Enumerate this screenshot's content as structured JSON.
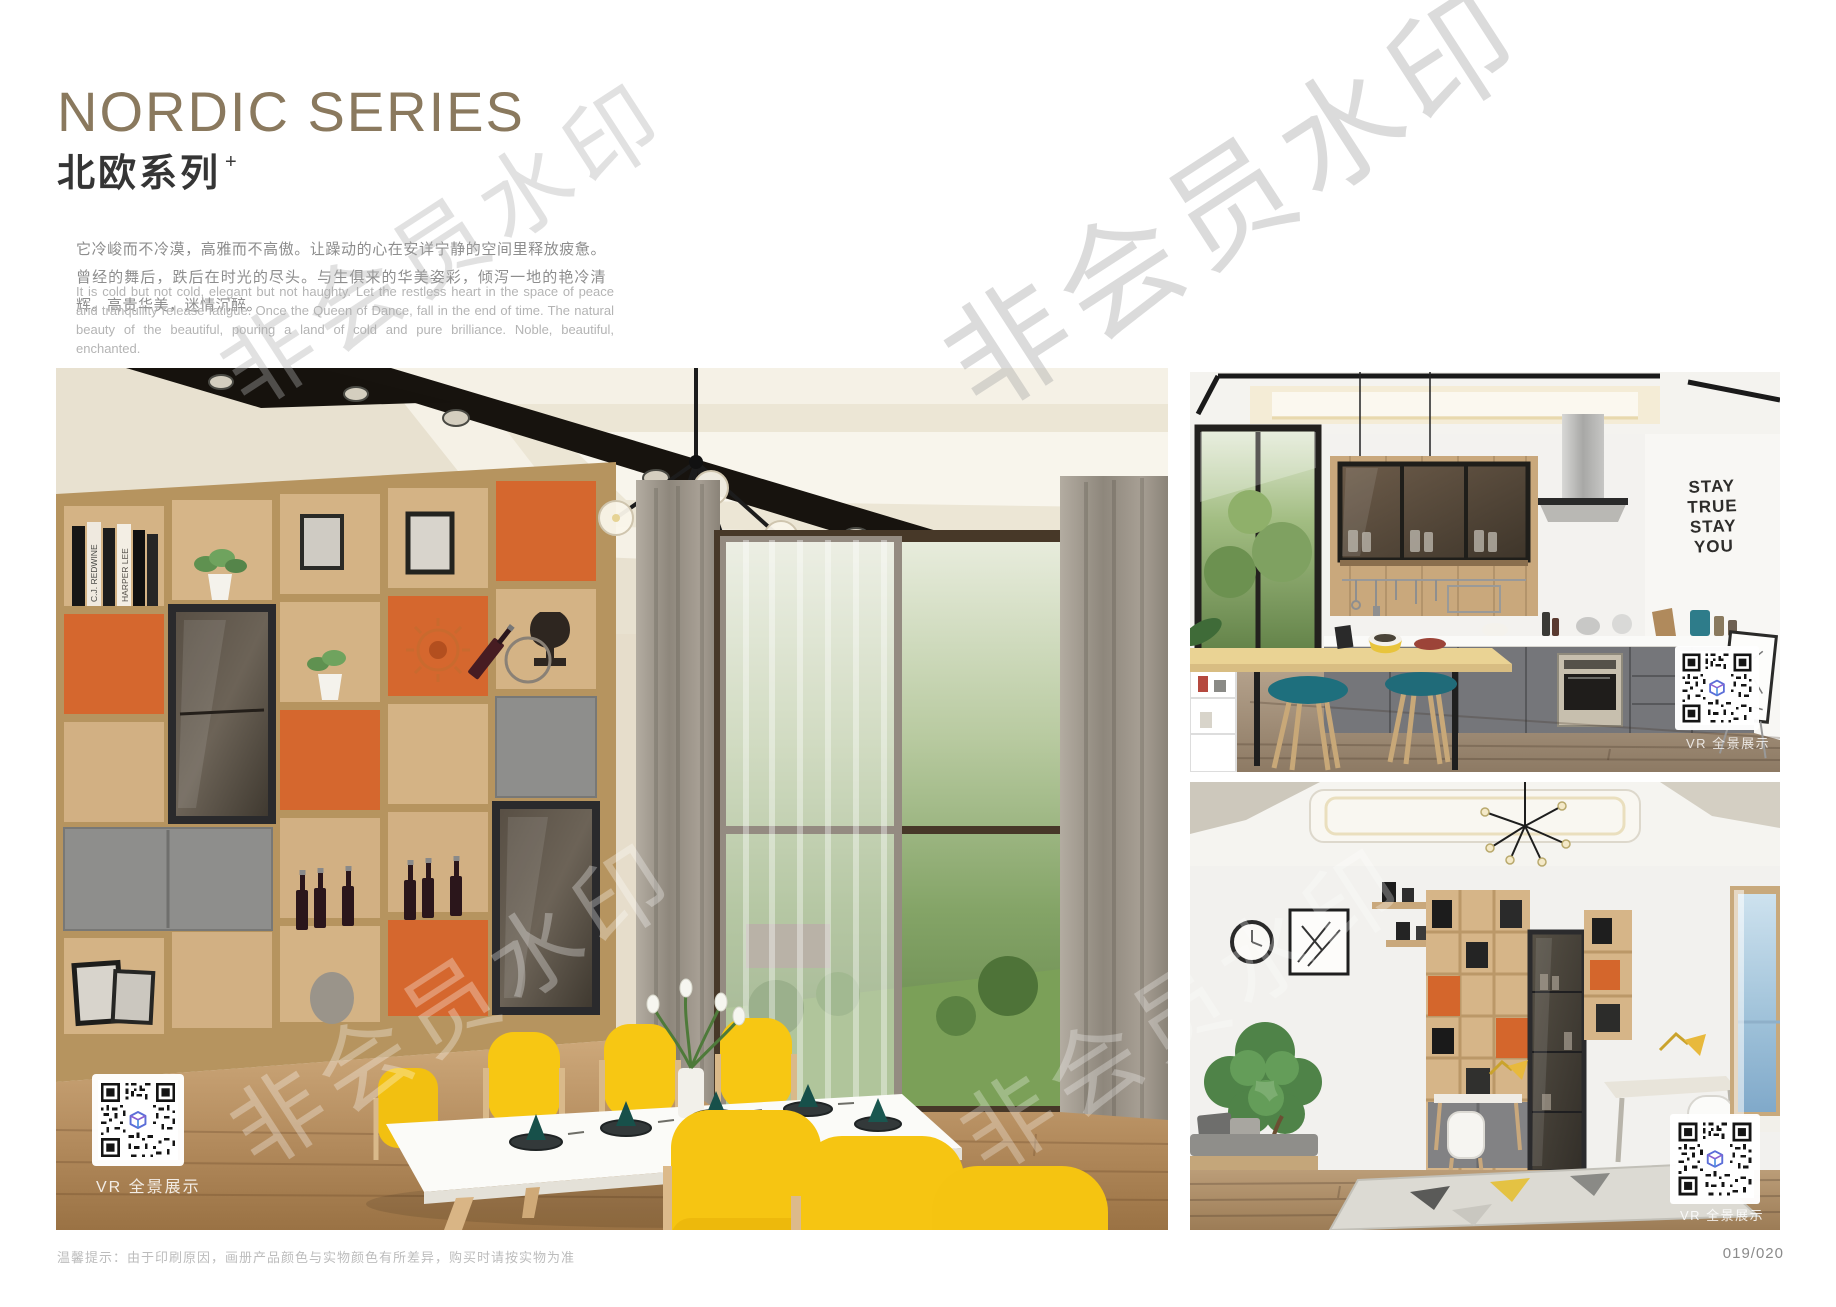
{
  "header": {
    "title_en": "NORDIC SERIES",
    "title_cn": "北欧系列",
    "title_superscript": "+",
    "intro_cn": "它冷峻而不冷漠，高雅而不高傲。让躁动的心在安详宁静的空间里释放疲惫。曾经的舞后，跌后在时光的尽头。与生俱来的华美姿彩，倾泻一地的艳冷清辉。高贵华美，迷情沉醉。",
    "intro_en": "It is cold but not cold, elegant but not haughty. Let the restless heart in the space of peace and tranquility release fatigue. Once the Queen of Dance, fall in the end of time. The natural beauty of the beautiful, pouring a land of cold and pure brilliance. Noble, beautiful, enchanted."
  },
  "watermark": {
    "text": "非会员水印"
  },
  "photos": {
    "dining": {
      "vr_label": "VR 全景展示",
      "book_spines": [
        "C.J. REDWINE",
        "HARPER LEE"
      ]
    },
    "kitchen": {
      "vr_label": "VR 全景展示",
      "wall_decal": [
        "STAY",
        "TRUE",
        "STAY",
        "YOU"
      ]
    },
    "study": {
      "vr_label": "VR 全景展示"
    }
  },
  "footer": {
    "note": "温馨提示：由于印刷原因，画册产品颜色与实物颜色有所差异，购买时请按实物为准",
    "page_number": "019/020"
  },
  "colors": {
    "title_brown": "#8a795e",
    "accent_orange": "#d4662c",
    "shelf_wood": "#d6b588",
    "chair_yellow": "#f6c713",
    "stool_teal": "#1e6f7d",
    "cabinet_gray": "#75767a"
  }
}
